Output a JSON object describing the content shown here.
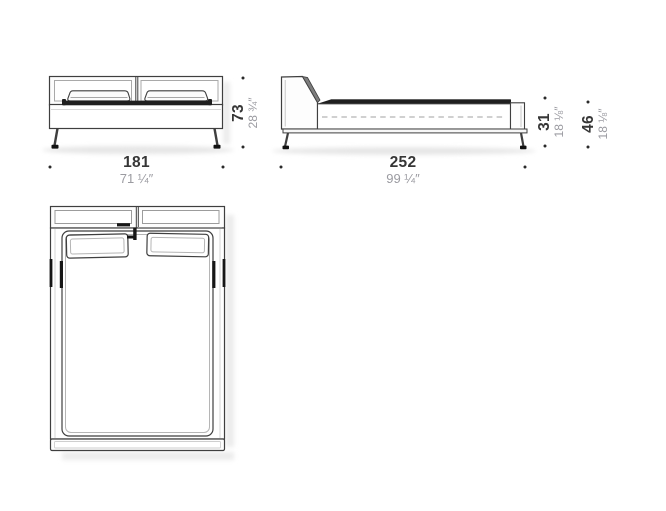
{
  "drawing_title": "bed-dimension-diagram",
  "colors": {
    "line_dark": "#3f3f3f",
    "line_light": "#b5b5b5",
    "fill_white": "#ffffff",
    "fill_dark": "#1f1f1f",
    "dim_number": "#363636",
    "dim_inch": "#9b9ba1",
    "shadow": "#e8e8e8"
  },
  "dimensions": {
    "front_width": {
      "cm": "181",
      "inch": "71 ¼″"
    },
    "front_height": {
      "cm": "73",
      "inch": "28 ¾″"
    },
    "side_length": {
      "cm": "252",
      "inch": "99 ¼″"
    },
    "side_rail_height": {
      "cm": "31",
      "inch": "18 ⅛″"
    },
    "side_top_height": {
      "cm": "46",
      "inch": "18 ⅛″"
    }
  }
}
